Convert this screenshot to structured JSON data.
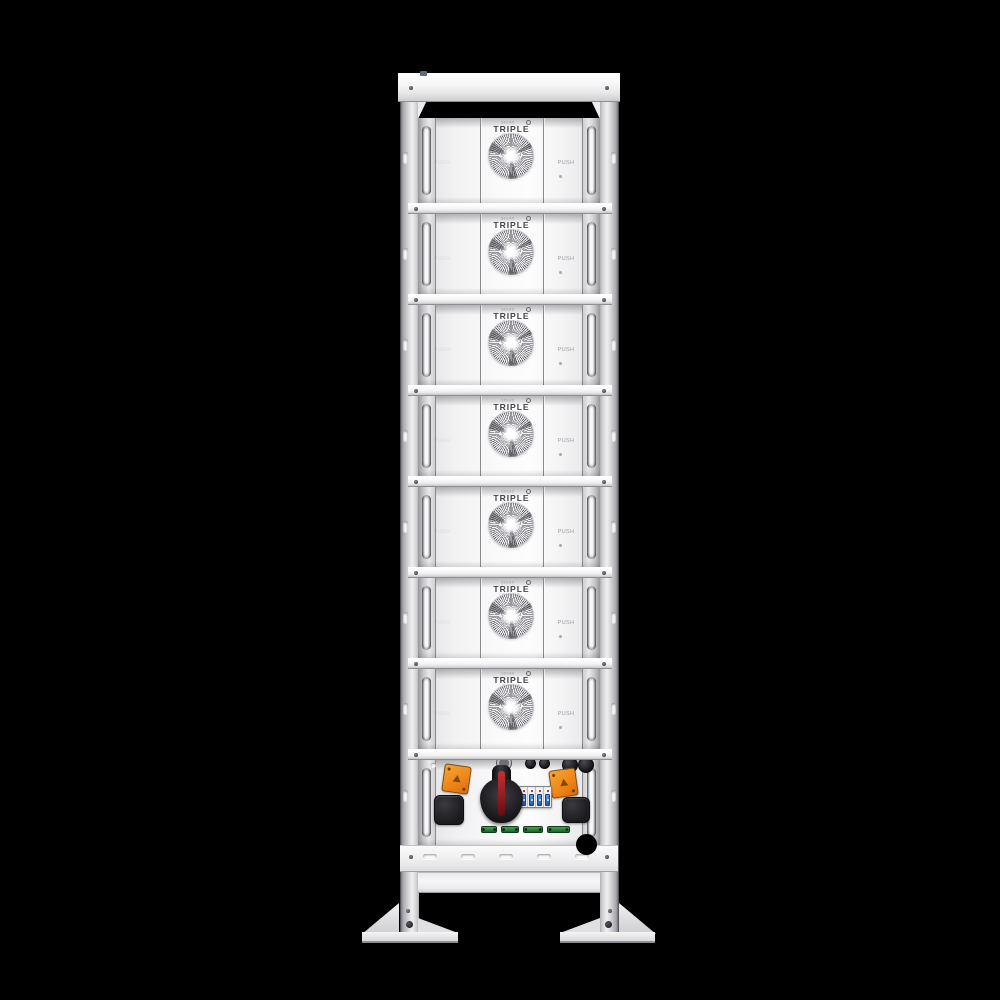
{
  "labels": {
    "brand_micro": "SOLAX",
    "logo_main": "TRIPLE",
    "logo_sub": "POWER",
    "push": "PUSH"
  },
  "modules": [
    {
      "index": 1
    },
    {
      "index": 2
    },
    {
      "index": 3
    },
    {
      "index": 4
    },
    {
      "index": 5
    },
    {
      "index": 6
    },
    {
      "index": 7
    }
  ],
  "counts": {
    "battery_modules": 7,
    "base_vent_slots": 5,
    "green_terminals": 4,
    "breaker_poles": 4
  },
  "colors": {
    "background": "#000000",
    "chassis_white": "#f2f2f3",
    "connector_orange": "#ef8718",
    "switch_knob_black": "#1a1a1d",
    "switch_stripe_red": "#a62226",
    "breaker_blue": "#2f6fd6",
    "terminal_green": "#2e8a3c"
  },
  "control_unit": {
    "components": [
      "dc-switch-knob",
      "circuit-breaker",
      "warning-connector-left",
      "warning-connector-right",
      "round-connectors",
      "cable-ports",
      "green-terminals"
    ]
  }
}
